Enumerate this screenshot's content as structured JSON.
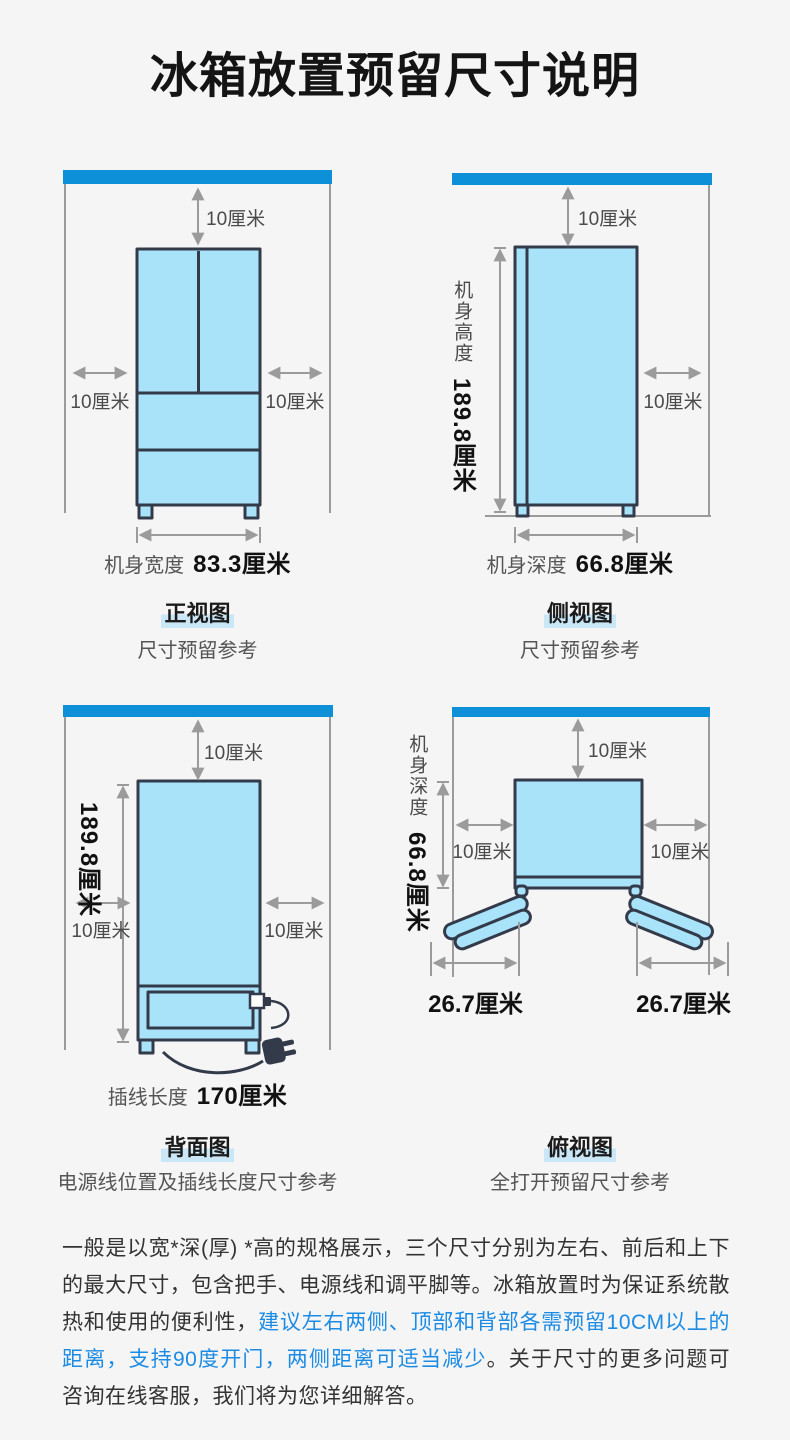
{
  "title": "冰箱放置预留尺寸说明",
  "views": {
    "front": {
      "title": "正视图",
      "subtitle": "尺寸预留参考",
      "clearance_top": "10厘米",
      "clearance_left": "10厘米",
      "clearance_right": "10厘米",
      "width_label": "机身宽度",
      "width_value": "83.3厘米"
    },
    "side": {
      "title": "侧视图",
      "subtitle": "尺寸预留参考",
      "clearance_top": "10厘米",
      "clearance_right": "10厘米",
      "height_label": "机身高度",
      "height_value": "189.8厘米",
      "depth_label": "机身深度",
      "depth_value": "66.8厘米"
    },
    "back": {
      "title": "背面图",
      "subtitle": "电源线位置及插线长度尺寸参考",
      "clearance_top": "10厘米",
      "clearance_left": "10厘米",
      "clearance_right": "10厘米",
      "height_value": "189.8厘米",
      "cord_label": "插线长度",
      "cord_value": "170厘米"
    },
    "top": {
      "title": "俯视图",
      "subtitle": "全打开预留尺寸参考",
      "clearance_top": "10厘米",
      "clearance_left": "10厘米",
      "clearance_right": "10厘米",
      "depth_label": "机身深度",
      "depth_value": "66.8厘米",
      "door_left_value": "26.7厘米",
      "door_right_value": "26.7厘米"
    }
  },
  "note": {
    "part1": "一般是以宽*深(厚) *高的规格展示，三个尺寸分别为左右、前后和上下的最大尺寸，包含把手、电源线和调平脚等。冰箱放置时为保证系统散热和使用的便利性，",
    "highlight": "建议左右两侧、顶部和背部各需预留10CM以上的距离，支持90度开门，两侧距离可适当减少",
    "part2": "。关于尺寸的更多问题可咨询在线客服，我们将为您详细解答。"
  },
  "colors": {
    "accent": "#0e90d9",
    "ink": "#333b4a",
    "fridge": "#a9e3fa",
    "line": "#9b9b9b",
    "hl": "#c9e7f6",
    "blue-text": "#1c8be4",
    "bg": "#f5f5f6"
  }
}
